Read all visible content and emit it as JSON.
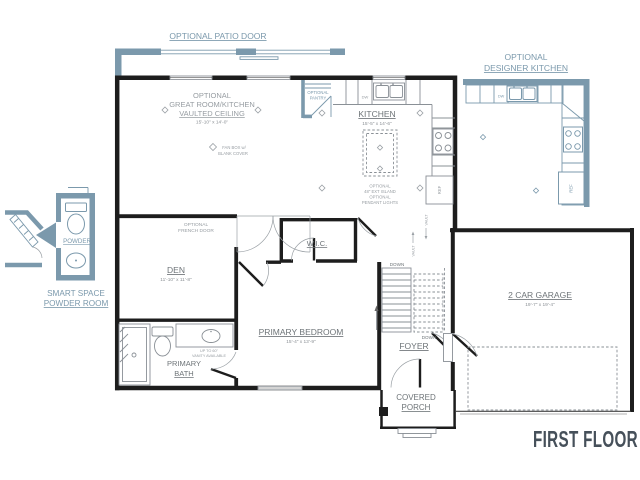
{
  "title": {
    "label": "FIRST FLOOR"
  },
  "colors": {
    "wall": "#1d1d1d",
    "optional_blue": "#7b99ac",
    "room_label_gray": "#6e7478",
    "note_gray": "#979da2",
    "title_color": "#46505a",
    "background": "#ffffff"
  },
  "annotations": {
    "patio_door_label": "OPTIONAL PATIO DOOR",
    "great_room": {
      "line1": "OPTIONAL",
      "line2": "GREAT ROOM/KITCHEN",
      "line3": "VAULTED CEILING",
      "dim": "15'-10\" x 14'-0\""
    },
    "fan_box": {
      "line1": "FAN BOX w/",
      "line2": "BLANK COVER"
    },
    "pantry": {
      "line1": "OPTIONAL",
      "line2": "PANTRY"
    },
    "kitchen": {
      "name": "KITCHEN",
      "dim": "15'-5\" x 14'-6\""
    },
    "island_note": {
      "line1": "OPTIONAL",
      "line2": "48\" EXT ISLAND",
      "line3": "OPTIONAL",
      "line4": "PENDANT LIGHTS"
    },
    "appliances": {
      "dishwasher": "DW",
      "refrigerator": "REF"
    },
    "vault_label": "VAULT",
    "designer_kitchen": {
      "line1": "OPTIONAL",
      "line2": "DESIGNER KITCHEN"
    },
    "powder_room": {
      "label": "POWDER",
      "caption1": "SMART SPACE",
      "caption2": "POWDER ROOM"
    },
    "den": {
      "name": "DEN",
      "dim": "11'-10\" x 11'-8\""
    },
    "french_door": {
      "line1": "OPTIONAL",
      "line2": "FRENCH DOOR"
    },
    "wic": {
      "name": "W.I.C."
    },
    "primary_bedroom": {
      "name": "PRIMARY BEDROOM",
      "dim": "15'-4\" x 13'-9\""
    },
    "primary_bath": {
      "line1": "PRIMARY",
      "line2": "BATH",
      "note1": "UP TO 60\"",
      "note2": "VANITY AVAILABLE"
    },
    "stairs": {
      "down": "DOWN"
    },
    "foyer": {
      "name": "FOYER"
    },
    "garage": {
      "name": "2 CAR GARAGE",
      "dim": "19'-7\" x 19'-4\""
    },
    "covered_porch": {
      "line1": "COVERED",
      "line2": "PORCH"
    }
  }
}
